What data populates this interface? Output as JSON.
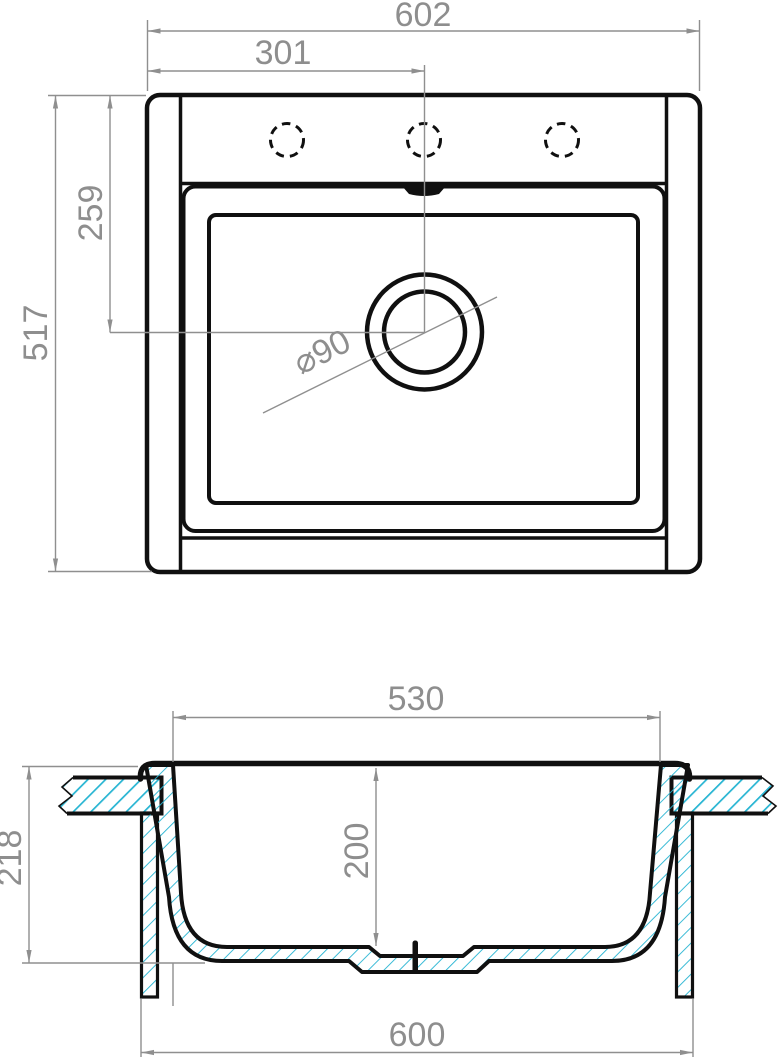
{
  "drawing": {
    "subject": "Kitchen sink technical drawing — top view and cross-section",
    "units": "mm",
    "views": [
      "top view",
      "front section"
    ],
    "labels": {
      "width_overall": "602",
      "hole_center_offset": "301",
      "depth_overall": "517",
      "drain_center_offset": "259",
      "drain_diameter": "⌀90",
      "bowl_width": "530",
      "bowl_depth": "200",
      "section_height": "218",
      "cabinet_width": "600"
    },
    "features": {
      "faucet_holes": 3,
      "drain_circles": 2
    },
    "colors": {
      "line": "#101010",
      "dimension": "#8e8e8e",
      "hatch": "#25b4d2",
      "background": "#ffffff"
    }
  }
}
